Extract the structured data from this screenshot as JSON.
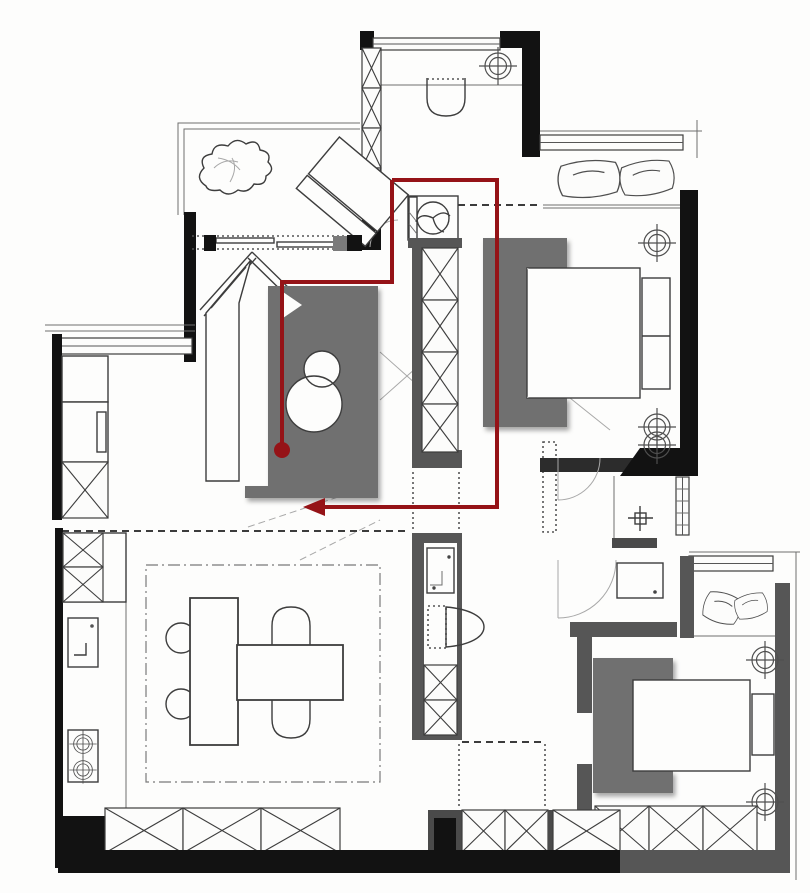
{
  "canvas": {
    "width": 810,
    "height": 893
  },
  "colors": {
    "wall_black": "#121212",
    "wall_gray": "#565656",
    "furniture_gray": "#6f6f6f",
    "line_dark": "#3d3d3d",
    "route_red": "#951317"
  },
  "route": {
    "color": "#951317",
    "stroke_width": 4,
    "main_path": [
      [
        392,
        180
      ],
      [
        497,
        180
      ],
      [
        497,
        507
      ],
      [
        323,
        507
      ]
    ],
    "branch_path": [
      [
        392,
        180
      ],
      [
        392,
        282
      ],
      [
        282,
        282
      ],
      [
        282,
        448
      ]
    ],
    "start_dot": {
      "x": 282,
      "y": 450,
      "r": 8
    },
    "arrow_tip": {
      "x": 303,
      "y": 507,
      "length": 22,
      "half_width": 9
    }
  },
  "fixtures": [
    "entry-door-swing",
    "shoe-cabinet-hatch",
    "ceiling-light",
    "washing-machine",
    "corridor-wardrobe-hatch",
    "balcony-plant",
    "lounge-chair",
    "sliding-window",
    "pillow",
    "double-bed",
    "nightstand",
    "tatami-desk",
    "overlapping-stools",
    "left-closet-hatch",
    "kitchen-sink",
    "cooktop-burners",
    "dining-table",
    "dining-chair",
    "round-stool",
    "rug-border",
    "vanity-sink",
    "toilet",
    "floor-drain-cross",
    "door-swing-arc",
    "storage-sideboard-hatch",
    "route-start-dot",
    "route-arrow"
  ]
}
